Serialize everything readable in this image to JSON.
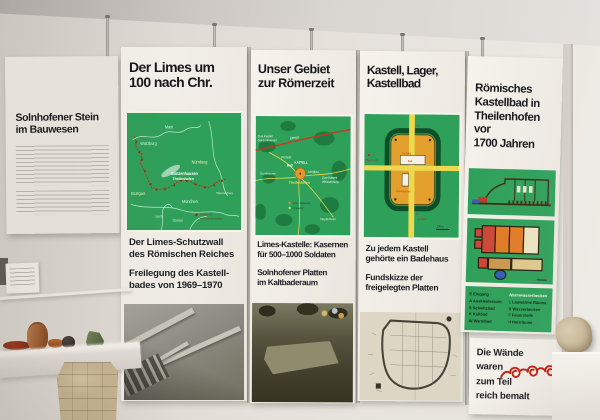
{
  "colors": {
    "map_green": "#2fa05a",
    "limes_red": "#a8401f",
    "kastell_orange": "#e4a02c",
    "road_yellow": "#ecd94e",
    "ornament_red": "#c01f14"
  },
  "panels": {
    "solnhofener": {
      "title_lines": [
        "Solnhofener Stein",
        "im Bauwesen"
      ]
    },
    "limes": {
      "title_lines": [
        "Der Limes um",
        "100 nach Chr."
      ],
      "map": {
        "main": "Main",
        "wuerzburg": "Würzburg",
        "nuernberg": "Nürnberg",
        "gunzenhausen": "Gunzenhausen",
        "theilenhofen": "Theilenhofen",
        "stuttgart": "Stuttgart",
        "muenchen": "München",
        "lech": "Lech",
        "donau": "Donau",
        "weissenburg": "Weissenburg",
        "legend1": "Limes mit",
        "legend2": "Kohortenkastellen"
      },
      "caption1_lines": [
        "Der Limes-Schutzwall",
        "des Römischen Reiches"
      ],
      "caption2_lines": [
        "Freilegung des Kastell-",
        "bades von 1969–1970"
      ]
    },
    "gebiet": {
      "title_lines": [
        "Unser Gebiet",
        "zur Römerzeit"
      ],
      "map": {
        "limes": "Limes",
        "zumkastell1a": "Zum Kastell",
        "zumkastell1b": "Gunzenhausen",
        "pfofeld": "Pfofeld",
        "bad": "BAD",
        "kastell": "KASTELL",
        "langlau": "Langlau",
        "dornhausen": "Dornhausen",
        "theilenhofen": "Theilenhofen",
        "zumkastell2a": "Zum Kastell",
        "zumkastell2b": "Weissenburg",
        "stopfenheim": "Stopfenheim",
        "legend_gebaeude": "Röm. Gebäude",
        "legend_strasse": "Römerstr."
      },
      "caption1_lines": [
        "Limes-Kastelle: Kasernen",
        "für 500–1000 Soldaten"
      ],
      "caption2_lines": [
        "Solnhofener Platten",
        "im Kaltbaderaum"
      ]
    },
    "kastell": {
      "title_lines": [
        "Kastell, Lager,",
        "Kastellbad"
      ],
      "diagram": {
        "wachturm": "Wachturm",
        "vorhalle": "Vorhalle",
        "bad": "Bad",
        "tor": "Tor",
        "kornspeicher": "Kornspeicher",
        "graben": "Graben",
        "scale": "100 m"
      },
      "caption1_lines": [
        "Zu jedem Kastell",
        "gehörte ein Badehaus"
      ],
      "caption2_lines": [
        "Fundskizze der",
        "freigelegten Platten"
      ]
    },
    "kastellbad": {
      "title_lines": [
        "Römisches",
        "Kastellbad in",
        "Theilenhofen",
        "vor",
        "1700 Jahren"
      ],
      "legend": {
        "col1": [
          "E Eingang",
          "A Auskleideraum",
          "S Schwitzbad",
          "K Kaltbad",
          "W Warmbad"
        ],
        "col2": [
          "Warmwasserbecken",
          "L Lauwarme Räume",
          "B Wasserbecken",
          "F Feuerstelle",
          "H Heizräume"
        ]
      },
      "caption_lines": [
        "Die Wände",
        "waren",
        "zum Teil",
        "reich bemalt"
      ]
    }
  }
}
